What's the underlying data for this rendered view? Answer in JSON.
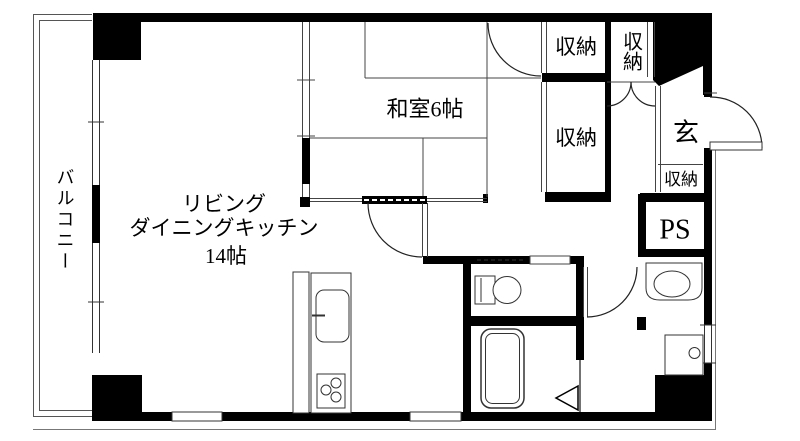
{
  "floorplan": {
    "type": "apartment-floor-plan",
    "labels": {
      "balcony": "バルコニー",
      "ldk_line1": "リビング",
      "ldk_line2": "ダイニングキッチン",
      "ldk_line3": "14帖",
      "japanese_room": "和室6帖",
      "closet_top": "収納",
      "closet_top_right": "収納",
      "closet_middle": "収納",
      "entrance": "玄",
      "entrance_closet": "収納",
      "pipe_space": "PS"
    },
    "colors": {
      "wall": "#000000",
      "line": "#333333",
      "background": "#ffffff"
    }
  }
}
